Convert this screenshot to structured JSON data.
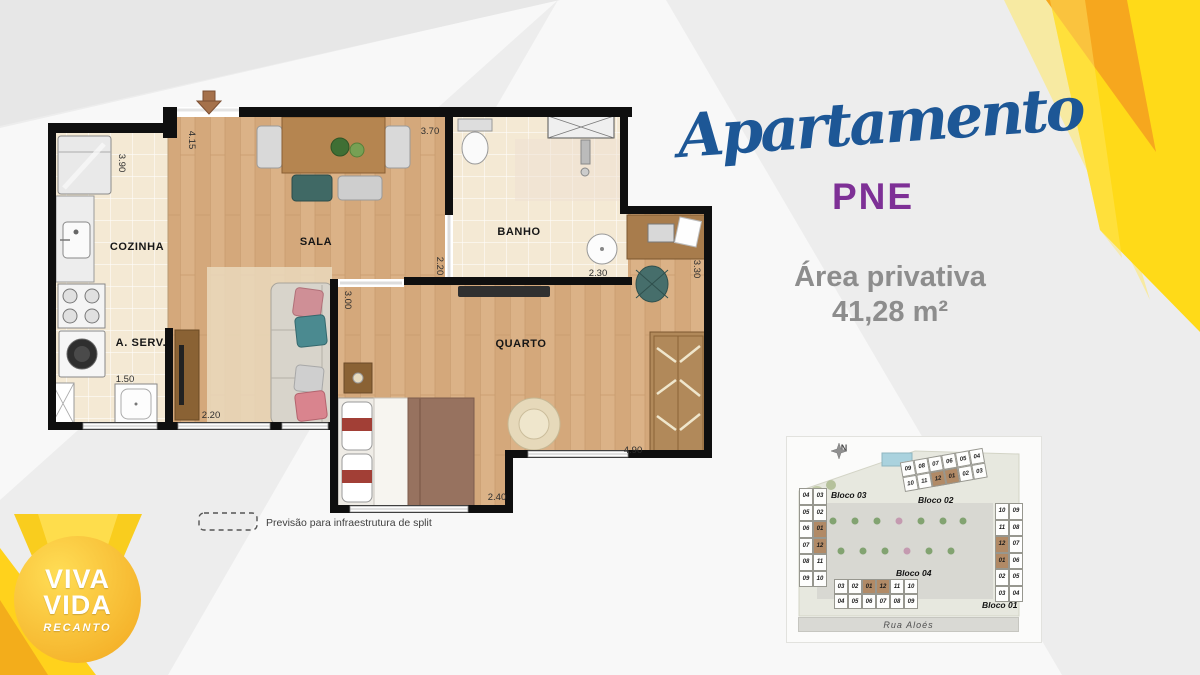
{
  "header": {
    "script_title": "Apartamento",
    "unit_type": "PNE",
    "area_label": "Área privativa",
    "area_value": "41,28 m²"
  },
  "floorplan": {
    "rooms": {
      "cozinha": "COZINHA",
      "aserv": "A. SERV.",
      "sala": "SALA",
      "banho": "BANHO",
      "quarto": "QUARTO"
    },
    "dims": {
      "d390": "3.90",
      "d415": "4.15",
      "d370": "3.70",
      "d220v": "2.20",
      "d230": "2.30",
      "d330": "3.30",
      "d300": "3.00",
      "d220h": "2.20",
      "d150": "1.50",
      "d490": "4.90",
      "d240": "2.40"
    },
    "legend_text": "Previsão para infraestrutura de split"
  },
  "logo": {
    "line1": "VIVA",
    "line2": "VIDA",
    "line3": "RECANTO"
  },
  "sitemap": {
    "compass_label": "N",
    "street": "Rua Aloés",
    "blocks": [
      {
        "id": "bloco03",
        "name": "Bloco 03",
        "rows": [
          [
            "04",
            "03"
          ],
          [
            "05",
            "02"
          ],
          [
            "06",
            "01"
          ],
          [
            "07",
            "12"
          ],
          [
            "08",
            "11"
          ],
          [
            "09",
            "10"
          ]
        ],
        "highlighted": [
          "01",
          "12"
        ]
      },
      {
        "id": "bloco02",
        "name": "Bloco 02",
        "rows": [
          [
            "09",
            "08",
            "07",
            "06",
            "05",
            "04"
          ],
          [
            "10",
            "11",
            "12",
            "01",
            "02",
            "03"
          ]
        ],
        "highlighted": [
          "01",
          "12"
        ]
      },
      {
        "id": "bloco04",
        "name": "Bloco 04",
        "rows": [
          [
            "03",
            "02",
            "01",
            "12",
            "11",
            "10"
          ],
          [
            "04",
            "05",
            "06",
            "07",
            "08",
            "09"
          ]
        ],
        "highlighted": [
          "01",
          "12"
        ]
      },
      {
        "id": "bloco01",
        "name": "Bloco 01",
        "rows": [
          [
            "10",
            "09"
          ],
          [
            "11",
            "08"
          ],
          [
            "12",
            "07"
          ],
          [
            "01",
            "06"
          ],
          [
            "02",
            "05"
          ],
          [
            "03",
            "04"
          ]
        ],
        "highlighted": [
          "01",
          "12"
        ]
      }
    ]
  },
  "colors": {
    "accent_blue": "#1d5796",
    "accent_purple": "#7e3096",
    "accent_yellow": "#ffda18",
    "accent_orange": "#f6a71e",
    "highlight_unit": "#b18a66"
  }
}
